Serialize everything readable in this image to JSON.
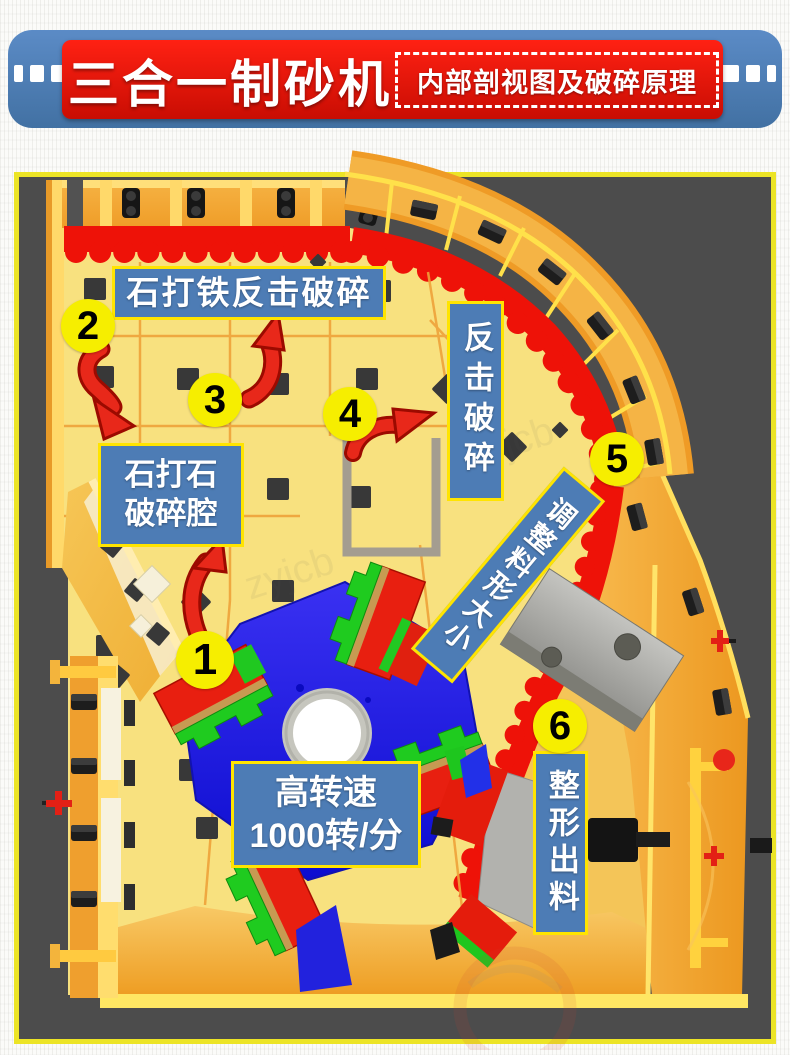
{
  "banner": {
    "title": "三合一制砂机",
    "subtitle": "内部剖视图及破碎原理",
    "colors": {
      "bar_blue": "#4f81bd",
      "box_red": "#e8130b",
      "text": "#ffffff"
    }
  },
  "diagram": {
    "labels": {
      "stone_iron_impact": "石打铁反击破碎",
      "stone_stone_line1": "石打石",
      "stone_stone_line2": "破碎腔",
      "impact_crush": "反击破碎",
      "adjust_size": "调整料形大小",
      "speed_line1": "高转速",
      "speed_line2": "1000转/分",
      "shaping_discharge": "整形出料"
    },
    "markers": [
      "1",
      "2",
      "3",
      "4",
      "5",
      "6"
    ],
    "watermark": "zyjcb",
    "colors": {
      "label_bg": "#4d7cb5",
      "label_border": "#ffe400",
      "marker_yellow": "#f6ee00",
      "frame_border": "#ece426",
      "background_gray": "#4c4c4c",
      "housing_yellow": "#f8e17f",
      "rim_orange": "#f5b445",
      "liner_red": "#ee1208",
      "rotor_blue": "#2a1fe8",
      "hammer_red": "#e81f10",
      "hammer_green": "#1fcb1f",
      "arrow_red": "#e8281a"
    }
  }
}
